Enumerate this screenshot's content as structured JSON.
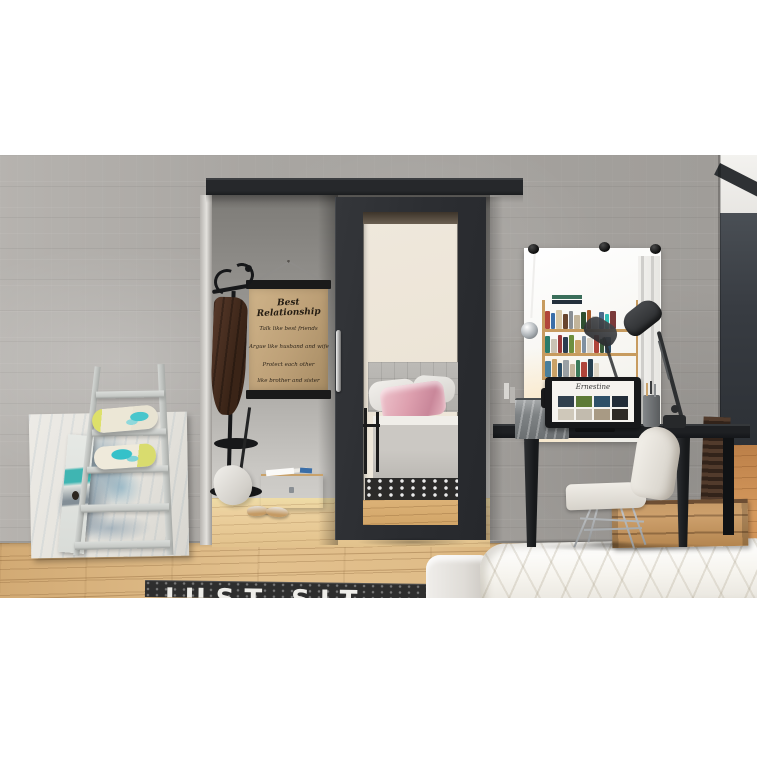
{
  "poster": {
    "title": "Best Relationship",
    "lines": [
      "Talk like best friends",
      "Argue like husband and wife",
      "Protect each other",
      "like brother and sister"
    ]
  },
  "rug": {
    "text": "JUST SIT"
  },
  "laptop": {
    "logo": "Ernestine"
  },
  "palette": {
    "door_black": "#2e3033",
    "rail_black": "#26282b",
    "wall_concrete": "#a9a6a2",
    "interior_wall": "#8f8d89",
    "floor_wood": "#ddb985",
    "accent_teal": "#35c1c9",
    "accent_pink": "#e3aab6",
    "poster_paper": "#c2a67e",
    "rug_dark": "#2e2e2e",
    "duvet_white": "#f7f5f1"
  }
}
